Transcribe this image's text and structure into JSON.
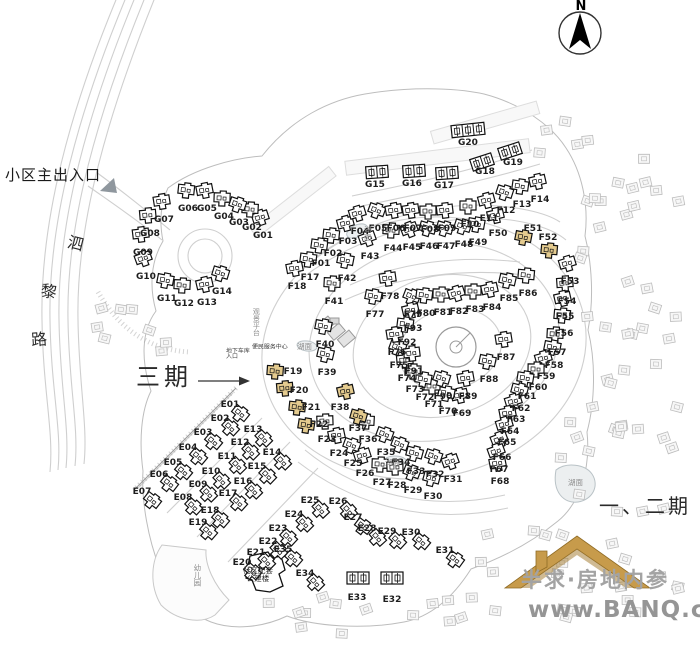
{
  "north": {
    "label": "N"
  },
  "labels": {
    "entrance": "小区主出入口",
    "phase3": "三期",
    "phase12": "一、二期",
    "road_chars": [
      "泗",
      "黎",
      "路"
    ],
    "lake": "湖面",
    "lake_positions": [
      {
        "x": 364,
        "y": 232,
        "v": true
      },
      {
        "x": 297,
        "y": 349,
        "v": false
      },
      {
        "x": 385,
        "y": 465,
        "v": false
      },
      {
        "x": 568,
        "y": 485,
        "v": false
      }
    ],
    "garage_line1": "地下车库",
    "garage_line2": "入口",
    "service_center": "便民服务中心",
    "viewing_platform": "观景平台",
    "facility_line1": "社区配套",
    "facility_line2": "公建楼",
    "kindergarten": "幼儿园"
  },
  "watermark": {
    "line1": "半求·房地内参",
    "line2": "www.BANQ.cn"
  },
  "colors": {
    "highlight": "#E4CB8F",
    "roof": "#C79B4B",
    "roof_edge": "#8F6B25",
    "road": "#cfcfcf",
    "context": "#bcbcbc"
  },
  "buildings": {
    "highlighted_ids": [
      "F19",
      "F20",
      "F21",
      "F22",
      "F37",
      "F38",
      "F51",
      "F52"
    ],
    "standard": [
      {
        "id": "G01",
        "x": 263,
        "y": 235
      },
      {
        "id": "G02",
        "x": 252,
        "y": 227
      },
      {
        "id": "G03",
        "x": 239,
        "y": 222
      },
      {
        "id": "G04",
        "x": 224,
        "y": 216
      },
      {
        "id": "G05",
        "x": 207,
        "y": 208
      },
      {
        "id": "G06",
        "x": 188,
        "y": 208
      },
      {
        "id": "G07",
        "x": 164,
        "y": 219
      },
      {
        "id": "G08",
        "x": 150,
        "y": 233
      },
      {
        "id": "G09",
        "x": 143,
        "y": 252
      },
      {
        "id": "G10",
        "x": 146,
        "y": 276
      },
      {
        "id": "G11",
        "x": 167,
        "y": 298
      },
      {
        "id": "G12",
        "x": 184,
        "y": 303
      },
      {
        "id": "G13",
        "x": 207,
        "y": 302
      },
      {
        "id": "G14",
        "x": 222,
        "y": 291
      },
      {
        "id": "F01",
        "x": 321,
        "y": 263
      },
      {
        "id": "F02",
        "x": 333,
        "y": 253
      },
      {
        "id": "F03",
        "x": 348,
        "y": 241
      },
      {
        "id": "F04",
        "x": 360,
        "y": 231
      },
      {
        "id": "F05",
        "x": 378,
        "y": 228
      },
      {
        "id": "F06",
        "x": 396,
        "y": 228
      },
      {
        "id": "F07",
        "x": 413,
        "y": 228
      },
      {
        "id": "F08",
        "x": 430,
        "y": 229
      },
      {
        "id": "F09",
        "x": 447,
        "y": 228
      },
      {
        "id": "F10",
        "x": 470,
        "y": 224
      },
      {
        "id": "F11",
        "x": 489,
        "y": 218
      },
      {
        "id": "F12",
        "x": 506,
        "y": 210
      },
      {
        "id": "F13",
        "x": 522,
        "y": 204
      },
      {
        "id": "F14",
        "x": 540,
        "y": 199
      },
      {
        "id": "F17",
        "x": 310,
        "y": 277
      },
      {
        "id": "F18",
        "x": 297,
        "y": 286
      },
      {
        "id": "F19",
        "x": 293,
        "y": 371,
        "dx": -18,
        "dy": 2
      },
      {
        "id": "F20",
        "x": 299,
        "y": 390,
        "dx": -14,
        "dy": 0
      },
      {
        "id": "F21",
        "x": 311,
        "y": 407,
        "dx": -14,
        "dy": 2
      },
      {
        "id": "F22",
        "x": 319,
        "y": 424,
        "dx": -13,
        "dy": 3
      },
      {
        "id": "F23",
        "x": 327,
        "y": 439
      },
      {
        "id": "F24",
        "x": 339,
        "y": 453
      },
      {
        "id": "F25",
        "x": 353,
        "y": 463
      },
      {
        "id": "F26",
        "x": 365,
        "y": 473
      },
      {
        "id": "F27",
        "x": 382,
        "y": 482
      },
      {
        "id": "F28",
        "x": 397,
        "y": 485
      },
      {
        "id": "F29",
        "x": 413,
        "y": 490
      },
      {
        "id": "F30",
        "x": 433,
        "y": 496
      },
      {
        "id": "F31",
        "x": 453,
        "y": 479
      },
      {
        "id": "F32",
        "x": 435,
        "y": 474
      },
      {
        "id": "F33",
        "x": 416,
        "y": 471
      },
      {
        "id": "F34",
        "x": 401,
        "y": 462
      },
      {
        "id": "F35",
        "x": 386,
        "y": 452
      },
      {
        "id": "F36",
        "x": 368,
        "y": 439
      },
      {
        "id": "F37",
        "x": 358,
        "y": 428,
        "dx": 0,
        "dy": -10
      },
      {
        "id": "F38",
        "x": 340,
        "y": 407,
        "dx": 6,
        "dy": -14
      },
      {
        "id": "F39",
        "x": 327,
        "y": 372
      },
      {
        "id": "F40",
        "x": 325,
        "y": 344
      },
      {
        "id": "F41",
        "x": 334,
        "y": 301
      },
      {
        "id": "F42",
        "x": 347,
        "y": 278
      },
      {
        "id": "F43",
        "x": 370,
        "y": 256
      },
      {
        "id": "F44",
        "x": 393,
        "y": 248
      },
      {
        "id": "F45",
        "x": 412,
        "y": 247
      },
      {
        "id": "F46",
        "x": 429,
        "y": 246
      },
      {
        "id": "F47",
        "x": 446,
        "y": 246
      },
      {
        "id": "F48",
        "x": 464,
        "y": 244
      },
      {
        "id": "F49",
        "x": 478,
        "y": 242
      },
      {
        "id": "F50",
        "x": 498,
        "y": 233
      },
      {
        "id": "F51",
        "x": 533,
        "y": 228,
        "dx": -10,
        "dy": 11
      },
      {
        "id": "F52",
        "x": 548,
        "y": 237,
        "dx": 1,
        "dy": 15
      },
      {
        "id": "F53",
        "x": 570,
        "y": 281
      },
      {
        "id": "F54",
        "x": 567,
        "y": 301
      },
      {
        "id": "F55",
        "x": 565,
        "y": 316
      },
      {
        "id": "F56",
        "x": 564,
        "y": 333
      },
      {
        "id": "F57",
        "x": 557,
        "y": 352
      },
      {
        "id": "F58",
        "x": 554,
        "y": 365
      },
      {
        "id": "F59",
        "x": 546,
        "y": 376
      },
      {
        "id": "F60",
        "x": 538,
        "y": 387
      },
      {
        "id": "F61",
        "x": 527,
        "y": 396
      },
      {
        "id": "F62",
        "x": 521,
        "y": 408
      },
      {
        "id": "F63",
        "x": 516,
        "y": 419
      },
      {
        "id": "F64",
        "x": 510,
        "y": 431
      },
      {
        "id": "F65",
        "x": 507,
        "y": 442
      },
      {
        "id": "F66",
        "x": 502,
        "y": 457
      },
      {
        "id": "F67",
        "x": 499,
        "y": 469
      },
      {
        "id": "F68",
        "x": 500,
        "y": 481
      },
      {
        "id": "F69",
        "x": 462,
        "y": 413
      },
      {
        "id": "F70",
        "x": 448,
        "y": 411
      },
      {
        "id": "F71",
        "x": 434,
        "y": 404
      },
      {
        "id": "F72",
        "x": 425,
        "y": 397
      },
      {
        "id": "F73",
        "x": 415,
        "y": 389
      },
      {
        "id": "F74",
        "x": 407,
        "y": 378
      },
      {
        "id": "F75",
        "x": 399,
        "y": 365
      },
      {
        "id": "F76",
        "x": 397,
        "y": 352
      },
      {
        "id": "F77",
        "x": 375,
        "y": 314
      },
      {
        "id": "F78",
        "x": 390,
        "y": 296
      },
      {
        "id": "F79",
        "x": 413,
        "y": 314
      },
      {
        "id": "F80",
        "x": 426,
        "y": 313
      },
      {
        "id": "F81",
        "x": 443,
        "y": 312
      },
      {
        "id": "F82",
        "x": 459,
        "y": 311
      },
      {
        "id": "F83",
        "x": 475,
        "y": 309
      },
      {
        "id": "F84",
        "x": 492,
        "y": 307
      },
      {
        "id": "F85",
        "x": 509,
        "y": 298
      },
      {
        "id": "F86",
        "x": 528,
        "y": 293
      },
      {
        "id": "F87",
        "x": 506,
        "y": 357
      },
      {
        "id": "F88",
        "x": 489,
        "y": 379
      },
      {
        "id": "F89",
        "x": 468,
        "y": 396
      },
      {
        "id": "F90",
        "x": 443,
        "y": 396
      },
      {
        "id": "F91",
        "x": 414,
        "y": 371
      },
      {
        "id": "F92",
        "x": 407,
        "y": 342
      },
      {
        "id": "F93",
        "x": 413,
        "y": 328
      },
      {
        "id": "E01",
        "x": 230,
        "y": 404
      },
      {
        "id": "E02",
        "x": 220,
        "y": 418
      },
      {
        "id": "E03",
        "x": 203,
        "y": 432
      },
      {
        "id": "E04",
        "x": 188,
        "y": 447
      },
      {
        "id": "E05",
        "x": 173,
        "y": 462
      },
      {
        "id": "E06",
        "x": 159,
        "y": 474
      },
      {
        "id": "E07",
        "x": 142,
        "y": 491
      },
      {
        "id": "E08",
        "x": 183,
        "y": 497
      },
      {
        "id": "E09",
        "x": 198,
        "y": 484
      },
      {
        "id": "E10",
        "x": 211,
        "y": 471
      },
      {
        "id": "E11",
        "x": 227,
        "y": 456
      },
      {
        "id": "E12",
        "x": 240,
        "y": 442
      },
      {
        "id": "E13",
        "x": 253,
        "y": 429
      },
      {
        "id": "E14",
        "x": 272,
        "y": 452
      },
      {
        "id": "E15",
        "x": 257,
        "y": 466
      },
      {
        "id": "E16",
        "x": 243,
        "y": 481
      },
      {
        "id": "E17",
        "x": 228,
        "y": 493
      },
      {
        "id": "E18",
        "x": 210,
        "y": 510
      },
      {
        "id": "E19",
        "x": 198,
        "y": 522
      },
      {
        "id": "E20",
        "x": 242,
        "y": 562
      },
      {
        "id": "E21",
        "x": 256,
        "y": 552
      },
      {
        "id": "E22",
        "x": 268,
        "y": 541
      },
      {
        "id": "E23",
        "x": 278,
        "y": 528
      },
      {
        "id": "E24",
        "x": 294,
        "y": 514
      },
      {
        "id": "E25",
        "x": 310,
        "y": 500
      },
      {
        "id": "E26",
        "x": 338,
        "y": 501
      },
      {
        "id": "E27",
        "x": 353,
        "y": 517
      },
      {
        "id": "E28",
        "x": 367,
        "y": 528
      },
      {
        "id": "E29",
        "x": 387,
        "y": 531
      },
      {
        "id": "E30",
        "x": 411,
        "y": 532
      },
      {
        "id": "E31",
        "x": 445,
        "y": 550
      },
      {
        "id": "E34",
        "x": 305,
        "y": 573
      },
      {
        "id": "E35",
        "x": 283,
        "y": 549
      }
    ],
    "rows": [
      {
        "id": "G15",
        "x": 375,
        "y": 184,
        "bx": 377,
        "by": 172,
        "u": 2,
        "rot": -4
      },
      {
        "id": "G16",
        "x": 412,
        "y": 183,
        "bx": 414,
        "by": 171,
        "u": 2,
        "rot": -4
      },
      {
        "id": "G17",
        "x": 444,
        "y": 185,
        "bx": 447,
        "by": 173,
        "u": 2,
        "rot": -4
      },
      {
        "id": "G18",
        "x": 485,
        "y": 171,
        "bx": 482,
        "by": 162,
        "u": 2,
        "rot": -18
      },
      {
        "id": "G19",
        "x": 513,
        "y": 162,
        "bx": 510,
        "by": 151,
        "u": 2,
        "rot": -18
      },
      {
        "id": "G20",
        "x": 468,
        "y": 142,
        "bx": 468,
        "by": 130,
        "u": 3,
        "rot": -6
      },
      {
        "id": "E32",
        "x": 392,
        "y": 599,
        "bx": 392,
        "by": 578,
        "u": 2,
        "rot": 0
      },
      {
        "id": "E33",
        "x": 357,
        "y": 597,
        "bx": 358,
        "by": 578,
        "u": 2,
        "rot": 0
      }
    ]
  }
}
